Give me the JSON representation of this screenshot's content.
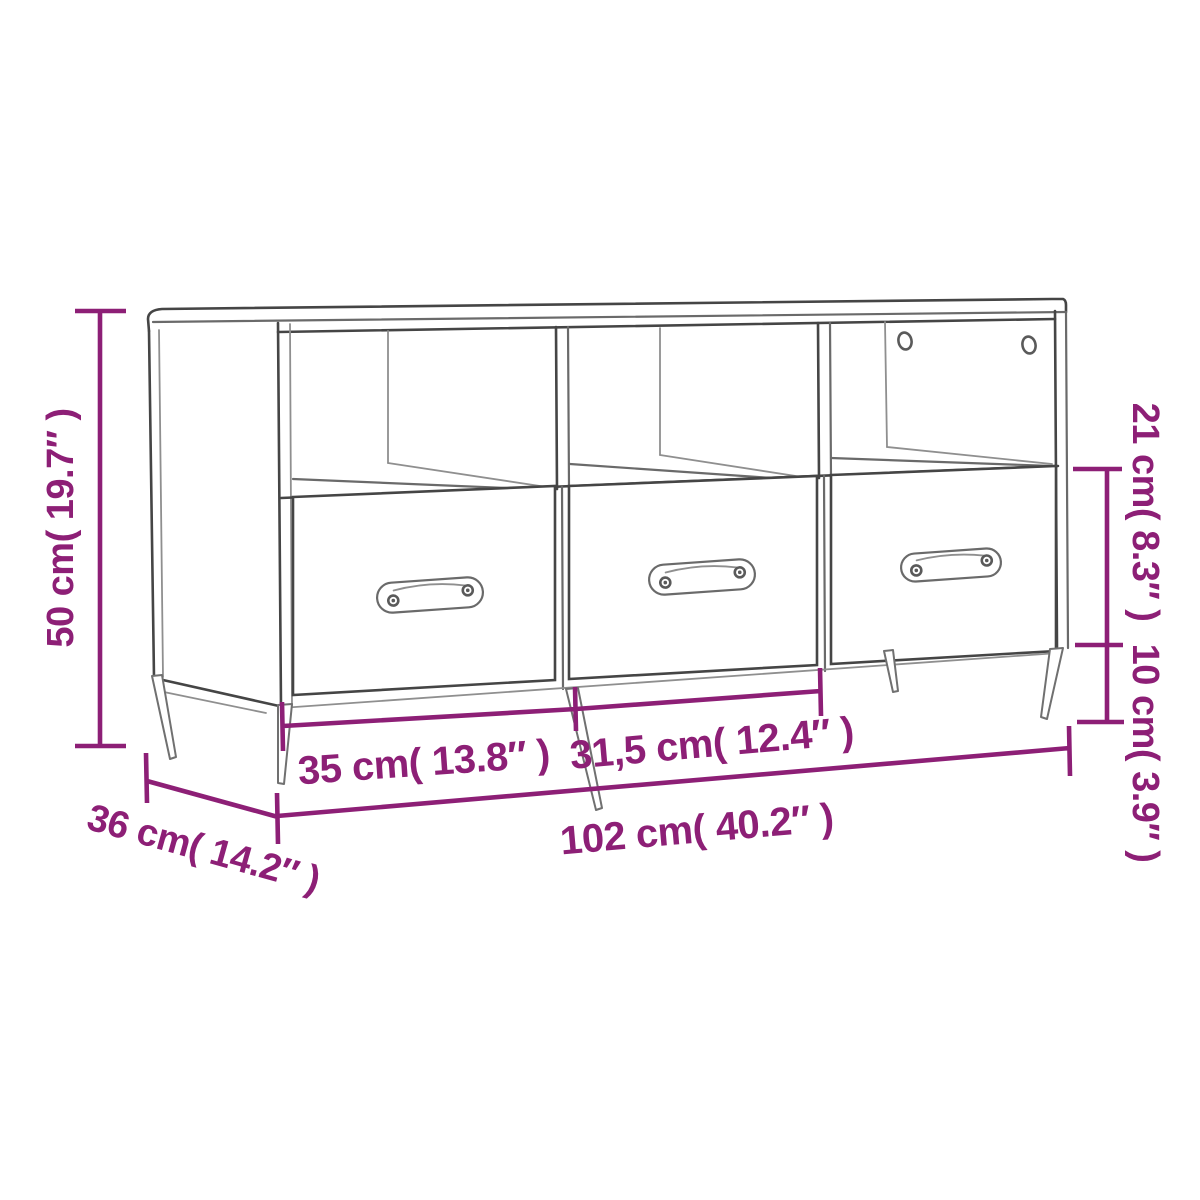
{
  "page": {
    "background": "#ffffff",
    "description": "Line-art furniture dimension diagram of a TV cabinet with three open compartments, three drawers with pill handles, and splayed tapered legs"
  },
  "colors": {
    "dimension_accent": "#8d1f76",
    "drawing_outline_dark": "#454545",
    "drawing_outline_light": "#8f8f8f"
  },
  "product": {
    "compartments": "3",
    "drawers": "3",
    "handles": "3",
    "back_panel_screw_holes": "2"
  },
  "dimensions": {
    "height": {
      "label": "50 cm( 19.7″ )",
      "cm": "50",
      "inches": "19.7",
      "position": "left",
      "orientation": "vertical"
    },
    "depth": {
      "label": "36 cm( 14.2″ )",
      "cm": "36",
      "inches": "14.2",
      "position": "bottom-left",
      "orientation": "diagonal"
    },
    "drawer_width_left": {
      "label": "35 cm( 13.8″ )",
      "cm": "35",
      "inches": "13.8",
      "position": "bottom",
      "orientation": "horizontal"
    },
    "drawer_width_middle": {
      "label": "31,5 cm( 12.4″ )",
      "cm": "31,5",
      "inches": "12.4",
      "position": "bottom",
      "orientation": "horizontal"
    },
    "total_width": {
      "label": "102 cm( 40.2″ )",
      "cm": "102",
      "inches": "40.2",
      "position": "bottom",
      "orientation": "horizontal"
    },
    "drawer_height": {
      "label": "21 cm( 8.3″ )",
      "cm": "21",
      "inches": "8.3",
      "position": "right",
      "orientation": "vertical"
    },
    "leg_height": {
      "label": "10 cm( 3.9″ )",
      "cm": "10",
      "inches": "3.9",
      "position": "right",
      "orientation": "vertical"
    }
  }
}
